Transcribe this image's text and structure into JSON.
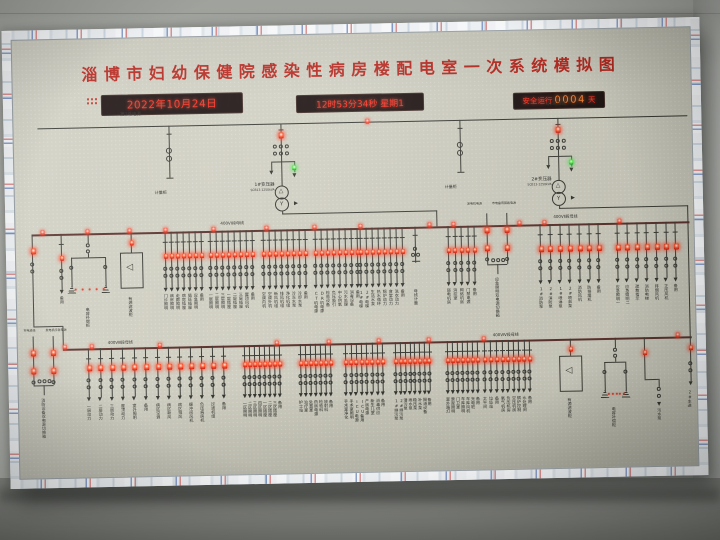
{
  "title": "淄博市妇幼保健院感染性病房楼配电室一次系统模拟图",
  "colors": {
    "title_red": "#b8241b",
    "led_red": "#ff2d1e",
    "led_amber": "#ff7e2e",
    "led_green": "#57e84f",
    "panel": "#cfcec1",
    "bus_dark": "#5b302b"
  },
  "displays": {
    "date": "2022年10月24日",
    "time": "12时53分34秒 星期1",
    "safe_prefix": "安全运行",
    "safe_days": "0004",
    "safe_suffix": "天"
  },
  "hv": {
    "left_source": "第1路电源",
    "right_source": "第2路电源",
    "left_meter": "计量柜",
    "right_meter": "计量柜",
    "t1_name": "1#变压器",
    "t1_spec": "SCB13-1250kVA",
    "t2_name": "2#变压器",
    "t2_spec": "SCB13-1250kVA"
  },
  "band1": {
    "bus_label_1": "400VⅠ段母线",
    "bus_label_2": "400VⅡ段母线",
    "bus_leds_x": [
      25,
      70,
      112,
      148,
      196,
      249,
      297,
      343,
      412,
      436,
      502,
      527,
      602
    ],
    "cap_label": "电容补偿柜",
    "box_label": "有源滤波柜",
    "ats": {
      "left_top": "发电机电源",
      "right_top": "市电备用回路电源",
      "out": "应急照明双电源切换箱"
    },
    "groups": [
      {
        "x": 45,
        "s": 6,
        "labels": [
          "备用"
        ]
      },
      {
        "x": 149,
        "s": 6,
        "labels": [
          "门诊照明",
          "病房照明",
          "走廊照明",
          "病房插座",
          "值班插座",
          "应急照明",
          "备用"
        ]
      },
      {
        "x": 194,
        "s": 6,
        "labels": [
          "一层照明",
          "二层照明",
          "三层照明",
          "一层插座",
          "二层插座",
          "三层插座",
          "屋顶风机",
          "备用"
        ]
      },
      {
        "x": 247,
        "s": 6,
        "labels": [
          "空调内机",
          "空调外机",
          "新风机组",
          "排风机组",
          "净化机组",
          "冷冻水泵",
          "冷却水泵",
          "备用"
        ]
      },
      {
        "x": 299,
        "s": 6,
        "labels": [
          "CT机电源",
          "DR机电源",
          "检验设备",
          "负压吸引",
          "中心供氧",
          "污水处理",
          "消毒设备",
          "备用"
        ]
      },
      {
        "x": 344,
        "s": 6,
        "labels": [
          "1#电梯",
          "2#电梯",
          "生活水泵",
          "热水循环",
          "锅炉动力",
          "食堂动力",
          "洗衣动力",
          "备用"
        ]
      },
      {
        "x": 399,
        "s": 6,
        "type": "pt",
        "labels": [
          "母线计量"
        ]
      },
      {
        "x": 432,
        "s": 6.5,
        "labels": [
          "弱电机房",
          "消控室",
          "网络机房",
          "门禁电源",
          "备用"
        ]
      },
      {
        "x": 524,
        "s": 9.7,
        "big": true,
        "labels": [
          "1#消防泵",
          "2#消防泵",
          "1#喷淋泵",
          "2#喷淋泵",
          "消防风机",
          "防排烟机",
          "备用"
        ]
      },
      {
        "x": 601,
        "s": 9.7,
        "big": true,
        "labels": [
          "应急照明一",
          "应急照明二",
          "疏散指示",
          "消防电梯",
          "排烟风机",
          "正压风机",
          "备用"
        ]
      }
    ]
  },
  "band2": {
    "bus_label_1": "400VⅢ段母线",
    "bus_label_2": "400VⅣ段母线",
    "bus_leds_x": [
      45,
      72,
      140,
      257,
      309,
      359,
      409,
      464,
      658
    ],
    "cap_label": "电容补偿柜",
    "box_label": "有源滤波柜",
    "ats": {
      "left_top": "市电进线",
      "right_top": "发电机应急电源",
      "out": "消防设备双电源切换箱"
    },
    "misc_label": "污水泵",
    "riser_label": "2#主进",
    "groups": [
      {
        "x": 70,
        "s": 11.4,
        "big": true,
        "labels": [
          "一层动力",
          "二层动力",
          "三层动力",
          "屋顶动力",
          "室外照明",
          "备用"
        ]
      },
      {
        "x": 139,
        "s": 11,
        "big": true,
        "labels": [
          "病区空调",
          "病区新风",
          "病区排风",
          "缓冲间风机",
          "负压病房机",
          "过滤机组",
          "备用"
        ]
      },
      {
        "x": 226,
        "s": 5,
        "labels": [
          "一区照明",
          "二区照明",
          "三区照明",
          "四区照明",
          "一区插座",
          "二区插座",
          "三区插座",
          "备用"
        ]
      },
      {
        "x": 282,
        "s": 5,
        "labels": [
          "护士站",
          "治疗室",
          "处置室",
          "药房电源",
          "检验科",
          "放射科",
          "备用"
        ]
      },
      {
        "x": 327,
        "s": 5.3,
        "labels": [
          "手术室净化",
          "手术室照明",
          "ICU电源",
          "ICU备用",
          "产房电源",
          "新生儿室",
          "消毒供应",
          "备用"
        ]
      },
      {
        "x": 377,
        "s": 4.8,
        "labels": [
          "1#排污泵",
          "2#排污泵",
          "潜污泵",
          "雨水泵",
          "稳压泵",
          "补水泵",
          "隔油设备",
          "备用"
        ]
      },
      {
        "x": 429,
        "s": 5,
        "labels": [
          "室外路灯",
          "景观照明",
          "门卫室",
          "车库照明",
          "车库风机",
          "充电桩",
          "备用"
        ]
      },
      {
        "x": 466,
        "s": 6,
        "labels": [
          "太平间",
          "垃圾站",
          "备用"
        ]
      },
      {
        "x": 484,
        "s": 5.4,
        "labels": [
          "氧气机房",
          "负压机房",
          "空压机房",
          "锅炉控制",
          "水处理间",
          "备用"
        ]
      }
    ]
  }
}
